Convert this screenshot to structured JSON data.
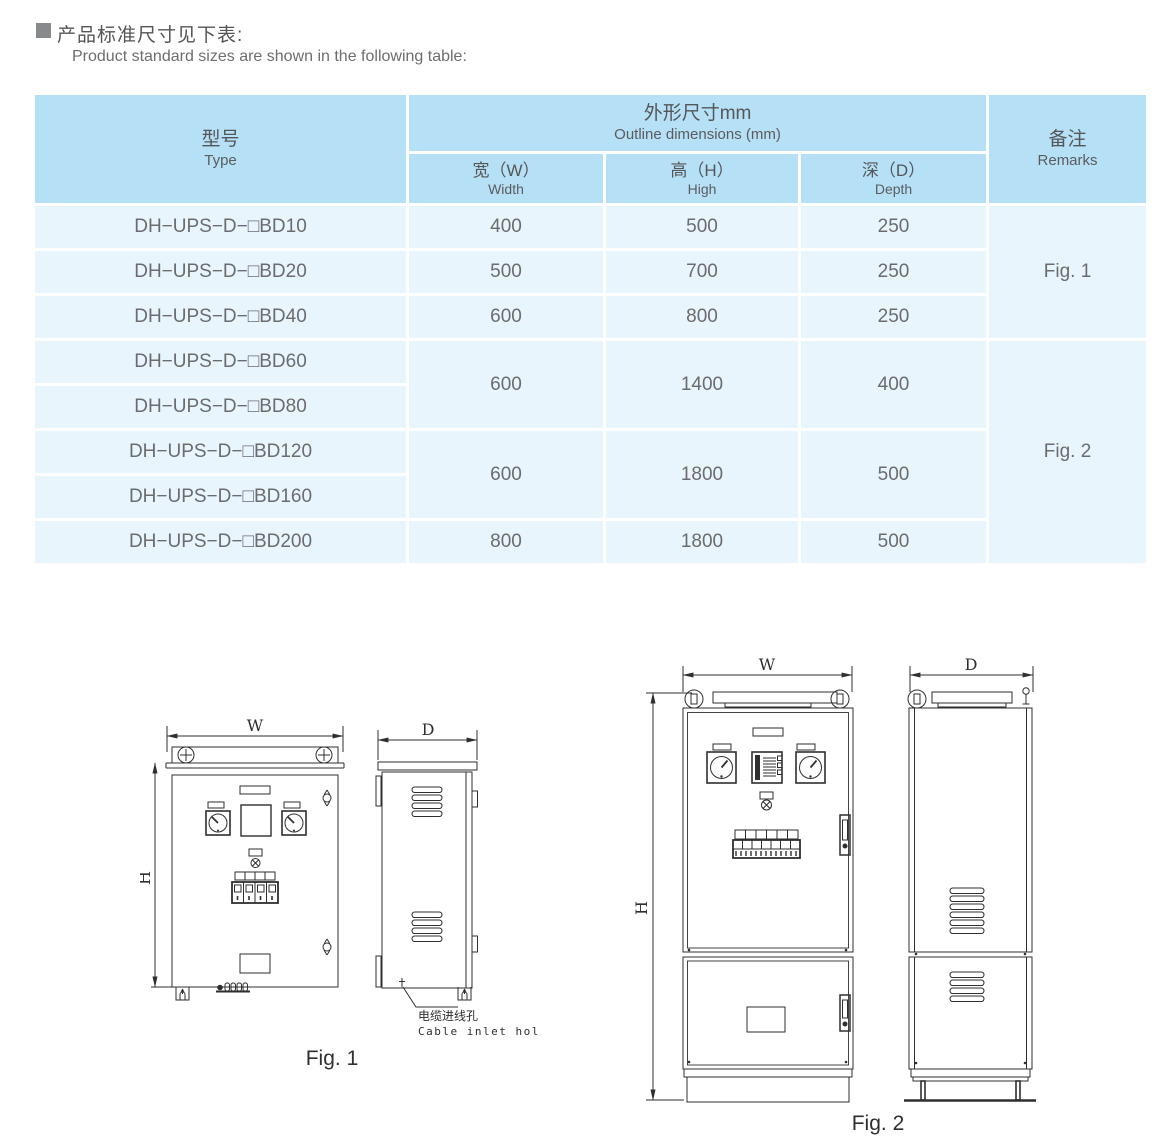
{
  "page": {
    "bullet_icon": "filled-square",
    "title_zh": "产品标准尺寸见下表:",
    "title_en": "Product standard sizes are shown in the following table:"
  },
  "colors": {
    "table_header_bg": "#b5e0f5",
    "table_row_bg": "#e8f5fc",
    "text_gray": "#6b6c6e",
    "drawing_line": "#2f2f31"
  },
  "table": {
    "header": {
      "type_zh": "型号",
      "type_en": "Type",
      "dims_zh": "外形尺寸mm",
      "dims_en": "Outline dimensions (mm)",
      "width_zh": "宽（W）",
      "width_en": "Width",
      "high_zh": "高（H）",
      "high_en": "High",
      "depth_zh": "深（D）",
      "depth_en": "Depth",
      "remarks_zh": "备注",
      "remarks_en": "Remarks"
    },
    "rows": [
      {
        "type": "DH−UPS−D−□BD10",
        "w": "400",
        "h": "500",
        "d": "250"
      },
      {
        "type": "DH−UPS−D−□BD20",
        "w": "500",
        "h": "700",
        "d": "250"
      },
      {
        "type": "DH−UPS−D−□BD40",
        "w": "600",
        "h": "800",
        "d": "250"
      },
      {
        "type": "DH−UPS−D−□BD60",
        "w": "600",
        "h": "1400",
        "d": "400"
      },
      {
        "type": "DH−UPS−D−□BD80"
      },
      {
        "type": "DH−UPS−D−□BD120",
        "w": "600",
        "h": "1800",
        "d": "500"
      },
      {
        "type": "DH−UPS−D−□BD160"
      },
      {
        "type": "DH−UPS−D−□BD200",
        "w": "800",
        "h": "1800",
        "d": "500"
      }
    ],
    "remark_groups": [
      {
        "label": "Fig. 1"
      },
      {
        "label": "Fig. 2"
      }
    ]
  },
  "fig1": {
    "caption": "Fig. 1",
    "labels": {
      "w": "W",
      "h": "H",
      "d": "D"
    },
    "cable_inlet_zh": "电缆进线孔",
    "cable_inlet_en": "Cable inlet hole"
  },
  "fig2": {
    "caption": "Fig. 2",
    "labels": {
      "w": "W",
      "h": "H",
      "d": "D"
    }
  }
}
